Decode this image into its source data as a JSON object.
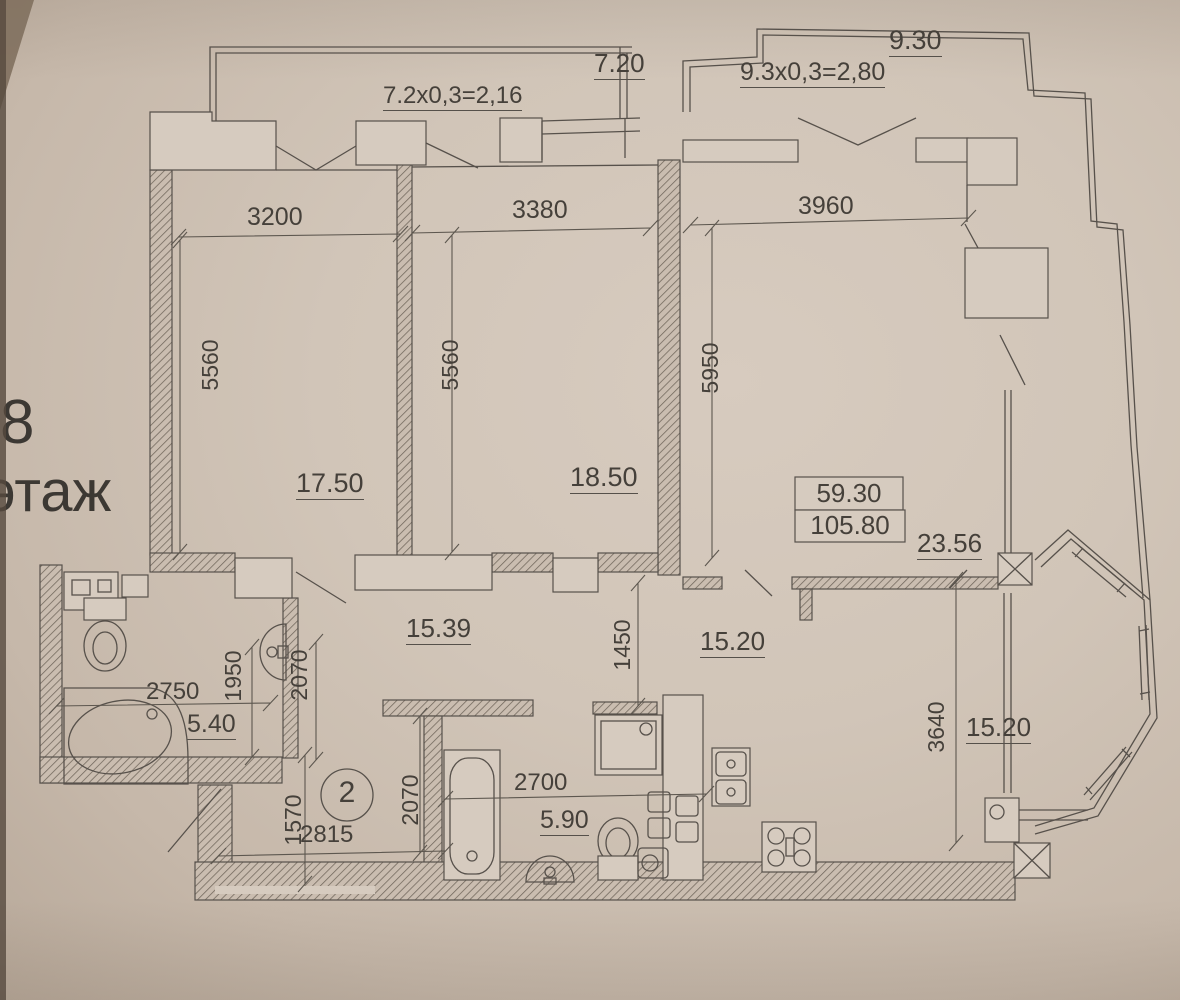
{
  "floor": {
    "number": "8",
    "word": "этаж"
  },
  "apartment": {
    "number_in_circle": "2",
    "living_area": "59.30",
    "total_area": "105.80",
    "summer_area": "23.56"
  },
  "balconies": {
    "left_calc": "7.2x0,3=2,16",
    "left_area": "7.20",
    "right_area": "9.30",
    "right_calc": "9.3x0,3=2,80"
  },
  "rooms": {
    "bedroom1": "17.50",
    "bedroom2": "18.50",
    "hall": "15.39",
    "kitchen": "15.20",
    "bay_room": "15.20",
    "bathroom": "5.40",
    "wc": "5.90"
  },
  "dimensions": {
    "bedroom1_width": "3200",
    "bedroom2_width": "3380",
    "living_width": "3960",
    "bedroom1_depth": "5560",
    "bedroom2_depth": "5560",
    "living_depth": "5950",
    "corridor": "1450",
    "kitchen_depth": "3640",
    "bathroom_width": "2750",
    "bathroom_depth": "1950",
    "bathroom_outer_depth": "2070",
    "bath_wall": "2070",
    "wc_width": "2700",
    "entry_width": "2815",
    "entry_depth": "1570"
  },
  "colors": {
    "paper": "#cfc3b6",
    "ink": "#45403a",
    "hatch": "#6f655a"
  }
}
